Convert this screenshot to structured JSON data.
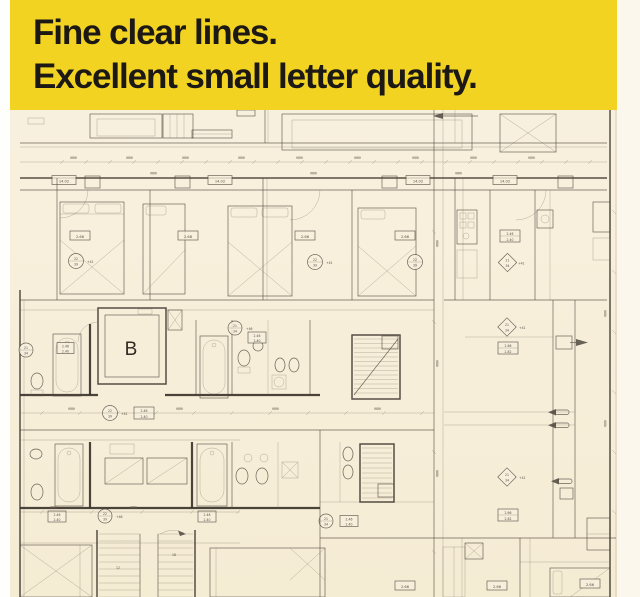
{
  "banner": {
    "line1": "Fine clear lines.",
    "line2": "Excellent small letter quality.",
    "background_color": "#f2d321",
    "text_color": "#1b1815"
  },
  "plan": {
    "paper_color": "#f7efdc",
    "ink_color": "#4d463d",
    "labels": {
      "elevator": "B",
      "window_width": "14.02",
      "room_area": "2.66",
      "room_area_alt": "2.68",
      "bath_area_top": "2.46",
      "bath_area_bottom": "2.40",
      "hall_area_top": "2.66",
      "hall_area_bottom": "2.82",
      "tag_a_top": "22",
      "tag_a_bottom": "39",
      "tag_b_top": "21",
      "tag_b_bottom": "34",
      "level_a": "+41",
      "level_b": "+46",
      "stair_count_a": "12",
      "stair_count_b": "18"
    }
  }
}
